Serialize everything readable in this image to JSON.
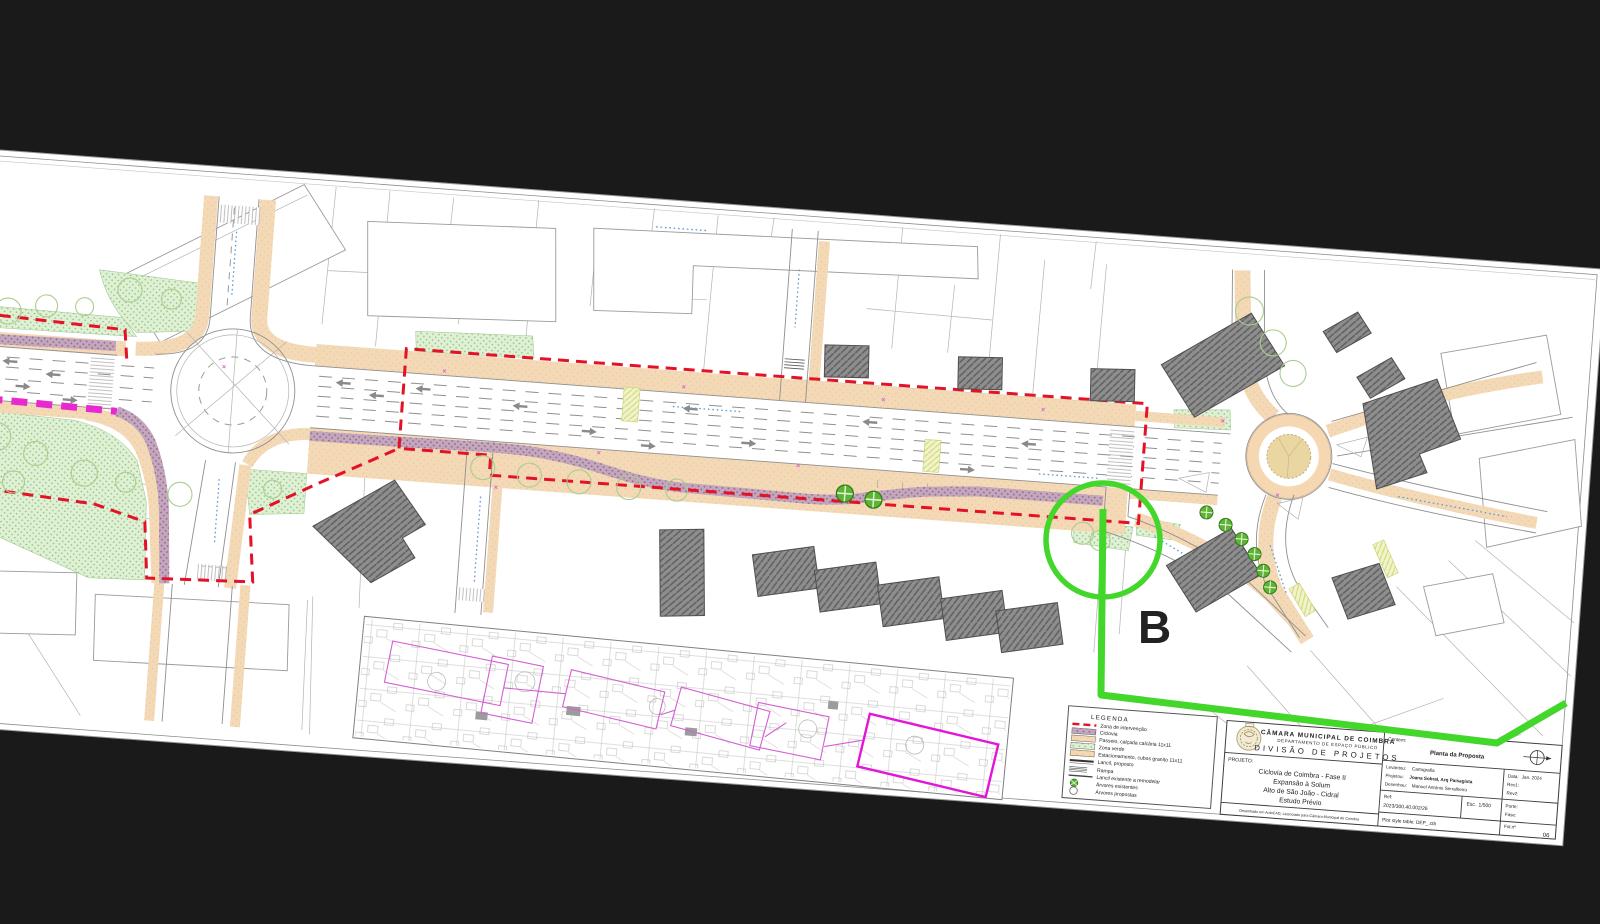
{
  "overlay": {
    "marker_label": "B",
    "color": "#3fd41f"
  },
  "legend": {
    "title": "LEGENDA",
    "items": [
      {
        "label": "Zona de intervenção",
        "symbol": "red-dashed-line"
      },
      {
        "label": "Ciclovia",
        "symbol": "mauve-swatch"
      },
      {
        "label": "Passeio, calçada calcária 11x11",
        "symbol": "tan-swatch"
      },
      {
        "label": "Zona verde",
        "symbol": "green-swatch"
      },
      {
        "label": "Estacionamento, cubos granito 11x11",
        "symbol": "tan-swatch"
      },
      {
        "label": "Lancil, proposto",
        "symbol": "double-line"
      },
      {
        "label": "Rampa",
        "symbol": "multi-line"
      },
      {
        "label": "Lancil existente a remodelar",
        "symbol": "single-line"
      },
      {
        "label": "Árvores existentes",
        "symbol": "green-tree-icon"
      },
      {
        "label": "Árvores propostas",
        "symbol": "open-circle-icon"
      }
    ]
  },
  "title_block": {
    "org_line1": "CÂMARA MUNICIPAL DE COIMBRA",
    "org_line2": "DEPARTAMENTO DE ESPAÇO PÚBLICO",
    "org_line3": "DIVISÃO DE PROJETOS",
    "projeto_label": "PROJETO:",
    "project_line1": "Ciclovia de Coimbra - Fase II",
    "project_line2": "Expansão à Solum",
    "project_line3": "Alto de São João - Cidral",
    "project_line4": "Estudo Prévio",
    "contem_label": "Contem:",
    "contem_value": "Planta da Proposta",
    "levantou_label": "Levantou:",
    "levantou_value": "Cartografia",
    "projetou_label": "Projetou:",
    "projetou_value": "Joana Sobral, Arq Paisagista",
    "desenhou_label": "Desenhou:",
    "desenhou_value": "Manuel António Serralheiro",
    "data_label": "Data:",
    "data_value": "Jan. 2024",
    "rev1_label": "Rev1:",
    "rev2_label": "Rev2:",
    "ref_label": "Ref:",
    "ref_value": "2023/300.40.002/26",
    "esc_label": "Esc.",
    "esc_value": "1/500",
    "porte_label": "Porte:",
    "fase_label": "Fase:",
    "plot_label": "Plot style table: DEP_.ctb",
    "folio_label": "Fol.nº",
    "folio_value": "06",
    "autocad_note": "Desenhado em AutoCAD, Licenciado para Câmara Municipal de Coimbra"
  },
  "colors": {
    "background": "#1a1a1a",
    "sheet": "#ffffff",
    "intervention_red": "#e31227",
    "ciclovia_mauve": "#c4a6bd",
    "sidewalk_tan": "#f3d7b3",
    "green_zone": "#dff0d5",
    "existing_ciclovia_magenta": "#e829cf",
    "overlay_green": "#43d62b",
    "inset_magenta": "#d45fd4"
  }
}
